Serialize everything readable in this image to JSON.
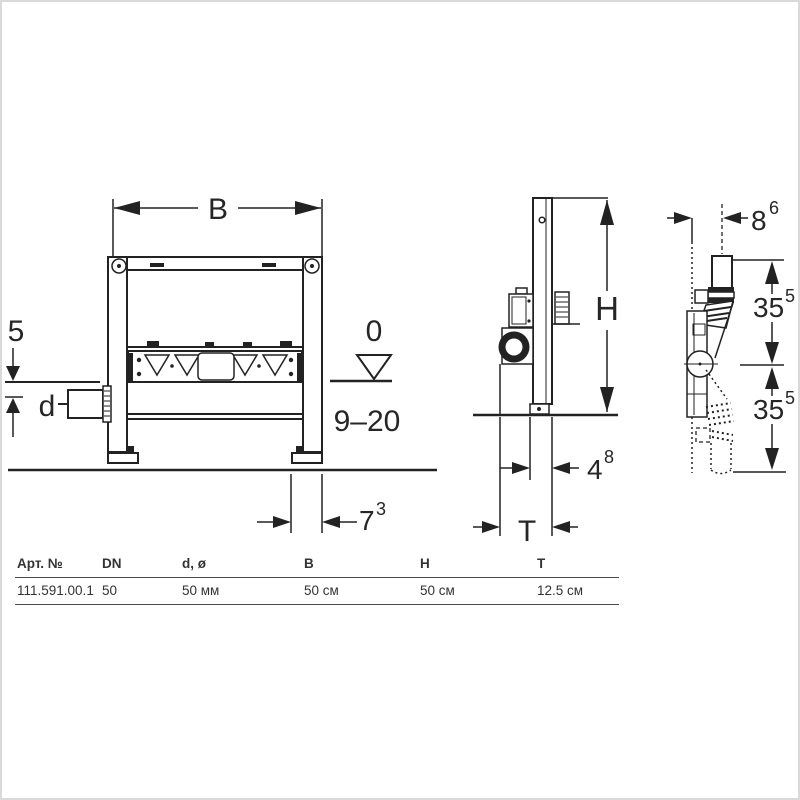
{
  "drawing": {
    "front_view": {
      "width_label": "B",
      "above_floor_label": "5",
      "inlet_label": "d",
      "zero_level_label": "0",
      "range_label": "9–20",
      "foot_dim": {
        "base": "7",
        "sup": "3"
      }
    },
    "side_view": {
      "height_label": "H",
      "foot_depth_dim": {
        "base": "4",
        "sup": "8"
      },
      "depth_label": "T"
    },
    "detail_view": {
      "offset_dim": {
        "base": "8",
        "sup": "6"
      },
      "upper_dim": {
        "base": "35",
        "sup": "5"
      },
      "lower_dim": {
        "base": "35",
        "sup": "5"
      }
    }
  },
  "table": {
    "headers": [
      "Арт. №",
      "DN",
      "d, ø",
      "B",
      "H",
      "T"
    ],
    "rows": [
      [
        "111.591.00.1",
        "50",
        "50 мм",
        "50 см",
        "50 см",
        "12.5 см"
      ]
    ]
  },
  "colors": {
    "line": "#222222",
    "text": "#262626",
    "table_rule": "#4a4a4a",
    "page_border": "#d9d9d9",
    "background": "#ffffff"
  }
}
